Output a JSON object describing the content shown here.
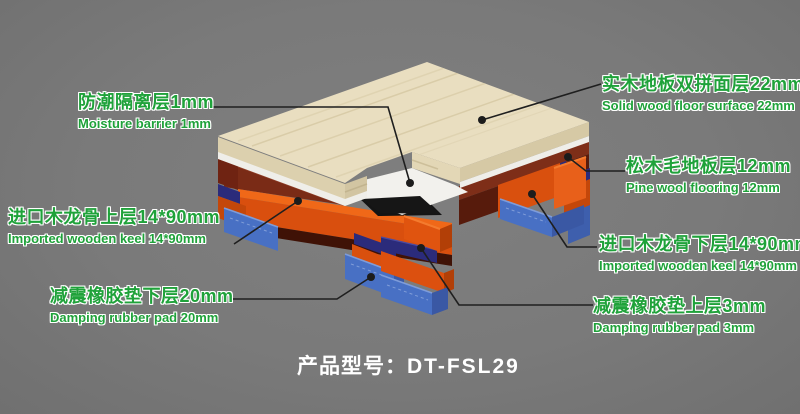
{
  "colors": {
    "background": "#7B7B7B",
    "label_green": "#1FA23A",
    "model_text": "#FFFFFF",
    "wood_surface_cream": "#E9DEC0",
    "pine_deck_brown": "#7A2B16",
    "keel_orange": "#DC500F",
    "keel_orange_bright": "#F06818",
    "rubber_pad_navy": "#2B2B7B",
    "rubber_pad_blue": "#4870C4",
    "moisture_white": "#F2F1ED"
  },
  "labels": [
    {
      "id": "moisture-barrier",
      "zh": "防潮隔离层1mm",
      "en": "Moisture barrier 1mm"
    },
    {
      "id": "solid-wood-surface",
      "zh": "实木地板双拼面层22mm",
      "en": "Solid wood floor surface 22mm"
    },
    {
      "id": "pine-flooring",
      "zh": "松木毛地板层12mm",
      "en": "Pine wool flooring 12mm"
    },
    {
      "id": "keel-upper",
      "zh": "进口木龙骨上层14*90mm",
      "en": "Imported wooden keel 14*90mm"
    },
    {
      "id": "keel-lower",
      "zh": "进口木龙骨下层14*90mm",
      "en": "Imported wooden keel 14*90mm"
    },
    {
      "id": "rubber-pad-lower",
      "zh": "减震橡胶垫下层20mm",
      "en": "Damping rubber pad 20mm"
    },
    {
      "id": "rubber-pad-upper",
      "zh": "减震橡胶垫上层3mm",
      "en": "Damping rubber pad 3mm"
    }
  ],
  "product_model": {
    "label": "产品型号：",
    "code": "DT-FSL29"
  }
}
